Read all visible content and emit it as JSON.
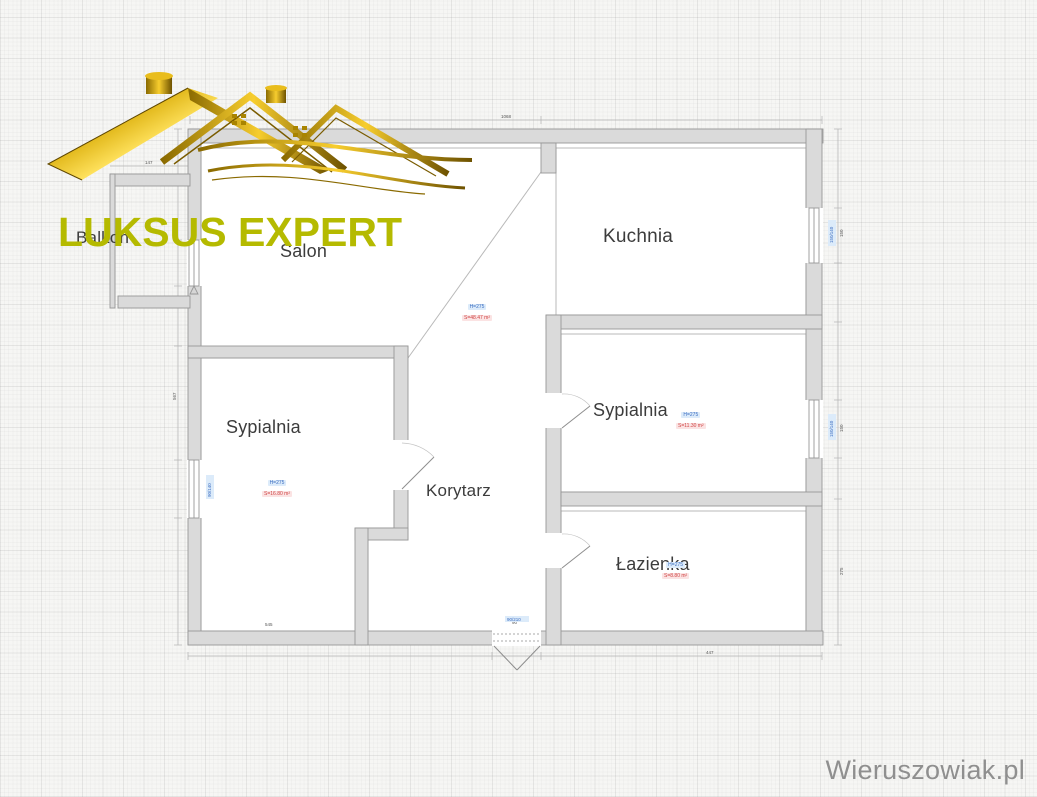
{
  "branding": {
    "logo_text": "LUKSUS EXPERT",
    "logo_color": "#b5ba00",
    "watermark": "Wieruszowiak.pl",
    "watermark_color": "#8f8f8f"
  },
  "plan": {
    "rooms": {
      "balkon": {
        "label": "Balkon"
      },
      "salon": {
        "label": "Salon",
        "height": "H=275",
        "area": "S=48.47 m²"
      },
      "kuchnia": {
        "label": "Kuchnia"
      },
      "sypialnia_left": {
        "label": "Sypialnia",
        "height": "H=275",
        "area": "S=16.80 m²"
      },
      "sypialnia_right": {
        "label": "Sypialnia",
        "height": "H=275",
        "area": "S=11.30 m²"
      },
      "korytarz": {
        "label": "Korytarz"
      },
      "lazienka": {
        "label": "Łazienka",
        "height": "H=275",
        "area": "S=8.80 m²"
      }
    },
    "annotation_colors": {
      "height_text": "#3a6cc0",
      "area_text": "#cf4545"
    },
    "dimensions": {
      "top": "1068",
      "balkon_top": "147",
      "bottom_left": "545",
      "bottom_right": "447",
      "entry_width": "90",
      "right_upper": "150",
      "right_lower": "150",
      "right_bottom": "275",
      "left_side": "567",
      "win_right_upper": "150/140",
      "win_right_lower": "150/140",
      "win_left": "90/140",
      "door_entry": "90/210"
    }
  }
}
